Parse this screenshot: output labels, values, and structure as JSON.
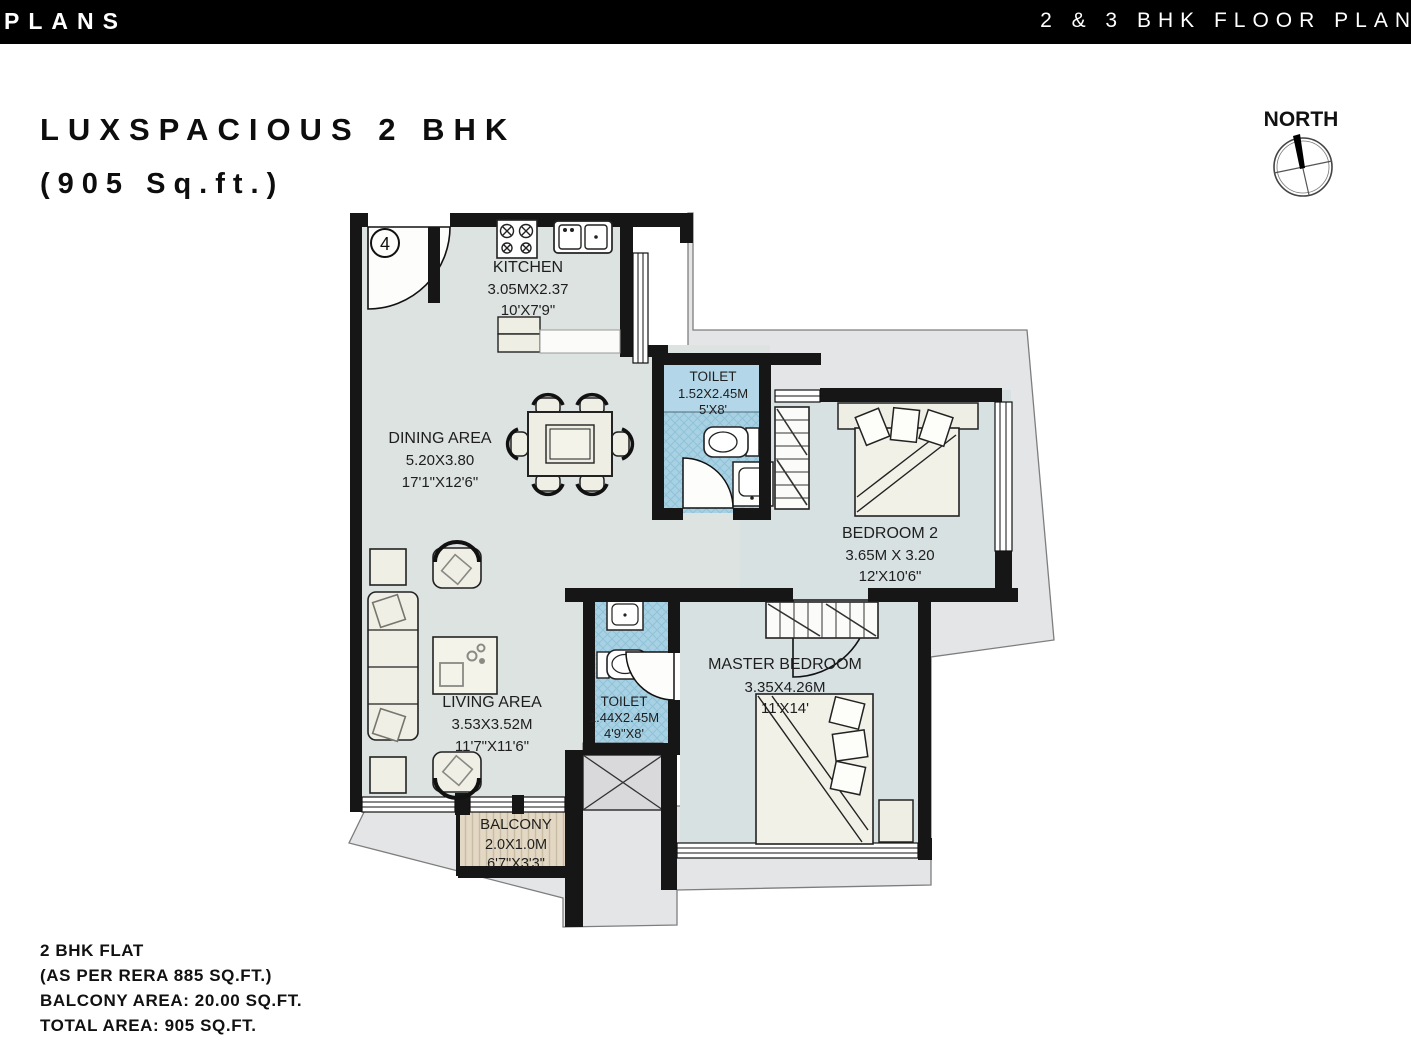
{
  "header": {
    "left": "PLANS",
    "right": "2 & 3 BHK FLOOR PLAN"
  },
  "title": {
    "line1": "LUXSPACIOUS 2 BHK",
    "line2": "(905 Sq.ft.)"
  },
  "compass": {
    "label": "NORTH"
  },
  "unit_number": "4",
  "rooms": [
    {
      "id": "kitchen",
      "name": "KITCHEN",
      "metric": "3.05MX2.37",
      "imperial": "10'X7'9\""
    },
    {
      "id": "dining",
      "name": "DINING AREA",
      "metric": "5.20X3.80",
      "imperial": "17'1\"X12'6\""
    },
    {
      "id": "toilet1",
      "name": "TOILET",
      "metric": "1.52X2.45M",
      "imperial": "5'X8'"
    },
    {
      "id": "bedroom2",
      "name": "BEDROOM 2",
      "metric": "3.65M X 3.20",
      "imperial": "12'X10'6\""
    },
    {
      "id": "living",
      "name": "LIVING AREA",
      "metric": "3.53X3.52M",
      "imperial": "11'7\"X11'6\""
    },
    {
      "id": "toilet2",
      "name": "TOILET",
      "metric": "1.44X2.45M",
      "imperial": "4'9\"X8'"
    },
    {
      "id": "master",
      "name": "MASTER BEDROOM",
      "metric": "3.35X4.26M",
      "imperial": "11'X14'"
    },
    {
      "id": "balcony",
      "name": "BALCONY",
      "metric": "2.0X1.0M",
      "imperial": "6'7\"X3'3\""
    }
  ],
  "footer": {
    "line1": "2 BHK FLAT",
    "line2": "(AS PER RERA 885 SQ.FT.)",
    "line3": "BALCONY AREA: 20.00 SQ.FT.",
    "line4": "TOTAL AREA: 905 SQ.FT."
  },
  "colors": {
    "wall": "#161616",
    "floor": "#dde3e1",
    "bedroom_floor": "#d8e1e2",
    "toilet_floor": "#b3d7e8",
    "balcony_floor": "#e3d8c4",
    "outside": "#e4e5e7",
    "furniture": "#f0efe5"
  }
}
